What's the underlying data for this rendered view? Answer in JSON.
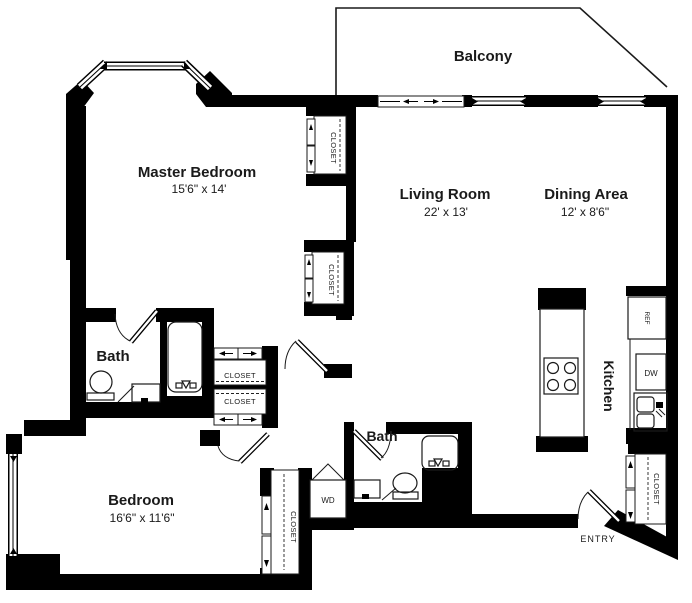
{
  "rooms": {
    "balcony": {
      "label": "Balcony"
    },
    "master_bedroom": {
      "label": "Master Bedroom",
      "dimensions": "15'6\" x 14'"
    },
    "living_room": {
      "label": "Living Room",
      "dimensions": "22' x 13'"
    },
    "dining_area": {
      "label": "Dining Area",
      "dimensions": "12' x 8'6\""
    },
    "bedroom": {
      "label": "Bedroom",
      "dimensions": "16'6\" x 11'6\""
    },
    "master_bath": {
      "label": "Bath"
    },
    "second_bath": {
      "label": "Bath"
    },
    "kitchen": {
      "label": "Kitchen"
    },
    "entry": {
      "label": "ENTRY"
    }
  },
  "closets": {
    "master_closet_upper": {
      "label": "CLOSET"
    },
    "master_closet_lower": {
      "label": "CLOSET"
    },
    "hall_closet_upper": {
      "label": "CLOSET"
    },
    "hall_closet_lower": {
      "label": "CLOSET"
    },
    "bedroom_closet": {
      "label": "CLOSET"
    },
    "entry_closet": {
      "label": "CLOSET"
    }
  },
  "appliances": {
    "washer_dryer": {
      "label": "WD"
    },
    "refrigerator": {
      "label": "REF"
    },
    "dishwasher": {
      "label": "DW"
    }
  },
  "colors": {
    "wall": "#000000",
    "line": "#1a1a1a",
    "background": "#ffffff"
  }
}
